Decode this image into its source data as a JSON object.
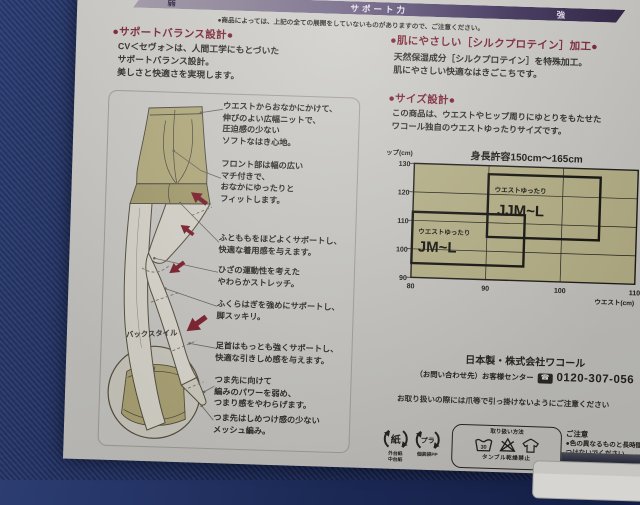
{
  "support_bar": {
    "weak": "弱",
    "label": "サポート力",
    "strong": "強"
  },
  "top_note": "●商品によっては、上記の全ての展開をしていないものがありますので、ご注意ください。",
  "support_balance": {
    "title": "●サポートバランス設計●",
    "body": "CV＜セヴォ＞は、人間工学にもとづいた\nサポートバランス設計。\n美しさと快適さを実現します。"
  },
  "silk": {
    "title": "●肌にやさしい［シルクプロテイン］加工●",
    "body": "天然保湿成分［シルクプロテイン］を特殊加工。\n肌にやさしい快適なはきごこちです。"
  },
  "size_design": {
    "title": "●サイズ設計●",
    "body": "この商品は、ウエストやヒップ周りにゆとりをもたせた\nワコール独自のウエストゆったりサイズです。"
  },
  "diagram": {
    "back_style_label": "バックスタイル",
    "callouts": [
      "ウエストからおなかにかけて、\n伸びのよい広幅ニットで、\n圧迫感の少ない\nソフトなはき心地。",
      "フロント部は幅の広い\nマチ付きで、\nおなかにゆったりと\nフィットします。",
      "ふとももをほどよくサポートし、\n快適な着用感を与えます。",
      "ひざの運動性を考えた\nやわらかストレッチ。",
      "ふくらはぎを強めにサポートし、\n脚スッキリ。",
      "足首はもっとも強くサポートし、\n快適な引きしめ感を与えます。",
      "つま先に向けて\n編みのパワーを弱め、\nつまり感をやわらげます。",
      "つま先はしめつけ感の少ない\nメッシュ編み。"
    ]
  },
  "chart_data": {
    "type": "area",
    "title": "身長許容150cm～165cm",
    "xlabel": "ウエスト(cm)",
    "ylabel": "ヒップ(cm)",
    "xlim": [
      80,
      110
    ],
    "ylim": [
      90,
      130
    ],
    "xticks": [
      80,
      90,
      100,
      110
    ],
    "yticks": [
      130,
      120,
      110,
      100,
      90
    ],
    "grid": true,
    "legend_position": "none",
    "regions": [
      {
        "label": "ウエストゆったり",
        "size": "JM~L",
        "waist_range": [
          80,
          95
        ],
        "hip_range": [
          95,
          113
        ]
      },
      {
        "label": "ウエストゆったり",
        "size": "JJM~L",
        "waist_range": [
          90,
          105
        ],
        "hip_range": [
          105,
          127
        ]
      }
    ]
  },
  "footer": {
    "made_in": "日本製・株式会社ワコール",
    "contact_prefix": "（お問い合わせ先）お客様センター",
    "phone": "0120-307-056",
    "handling_note": "お取り扱いの際には爪等で引っ掛けないようにご注意ください",
    "paper_mark": "紙",
    "paper_sub": "外台紙\n中台紙",
    "plastic_mark": "プラ",
    "plastic_sub": "個装袋PP",
    "care": {
      "title": "取り扱い方法",
      "wash_temp": "30",
      "tumble": "タンブル乾燥禁止"
    },
    "caution": {
      "title": "ご注意",
      "body": "●色の異なるものと長時間いっしょに洗液に\nつけないでください。"
    }
  },
  "icons": {
    "freedial": "☎"
  },
  "colors": {
    "heading_maroon": "#7d2334",
    "bar_purple": "#3c2f58",
    "chart_khaki": "#b5b086",
    "tights_khaki": "#b4ac7e",
    "arrow_red": "#7c1f2d",
    "denim_background": "#1b2854",
    "sheet_gray": "#c9c8c4"
  }
}
